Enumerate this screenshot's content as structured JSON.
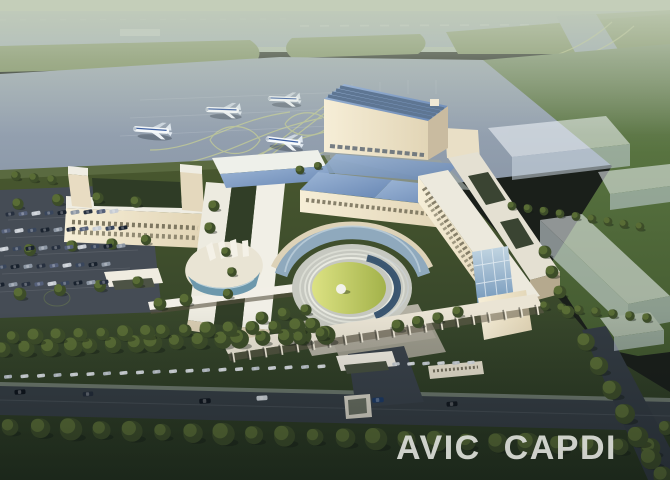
{
  "image": {
    "kind": "architectural aerial rendering",
    "subject": "AVIC CAPDI campus beside an airport apron at dusk",
    "aircraft_count": 4
  },
  "watermark": {
    "text": "AVIC CAPDI",
    "color": "#d8dad4"
  },
  "palette": {
    "haze": "#c3cdb8",
    "runway": "#a2afbf",
    "far_grass": "#7f9163",
    "apron": "#94a1b1",
    "airfield_green": "#57713f",
    "campus_lawn": "#3f4e2c",
    "foreground_lawn": "#2b3a27",
    "road": "#363e44",
    "building_lit": "#f3ead1",
    "building_shade": "#bcb096",
    "roof_white": "#efede3",
    "roof_glass": "#7e9cc4",
    "courtyard_lawn": "#c3cc5e",
    "water": "#2a4866",
    "tree": "#42522c"
  },
  "objects": [
    "hazy horizon",
    "distant runway",
    "grass medians",
    "taxiway connector",
    "aircraft apron",
    "taxiway guide lines",
    "four parked airliners",
    "maintenance hangar",
    "headquarters halls with glass roofs",
    "U-shaped office building",
    "twin office slabs",
    "oval glass auditorium",
    "circular lawn courtyard with dome",
    "curved glass atrium",
    "east office complex",
    "pergola walkway",
    "entrance gate",
    "guard canopy",
    "translucent future-phase buildings",
    "tree rows",
    "parking lot with cars",
    "access road with cars",
    "watermark lettering"
  ]
}
